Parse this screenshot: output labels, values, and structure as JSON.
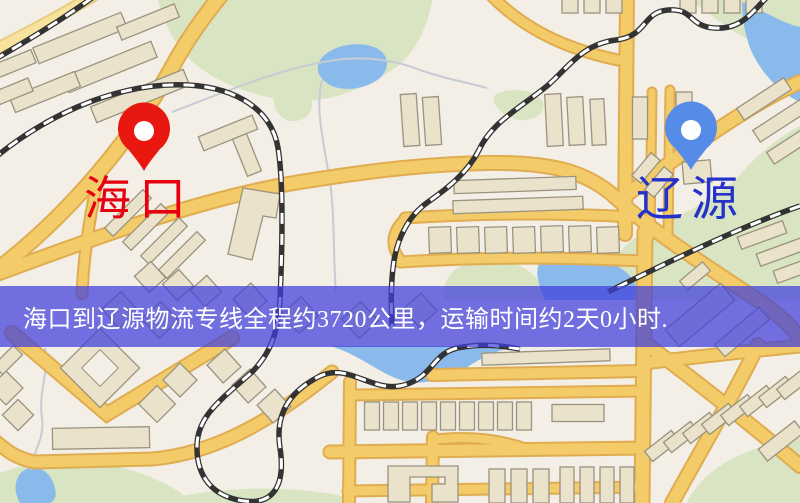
{
  "map": {
    "origin": {
      "label": "海口"
    },
    "destination": {
      "label": "辽源"
    },
    "banner": {
      "text": "海口到辽源物流专线全程约3720公里，运输时间约2天0小时."
    },
    "colors": {
      "origin_marker": "#e8170f",
      "origin_label": "#e60010",
      "destination_marker": "#568be8",
      "destination_label": "#2531cb",
      "banner_bg": "rgba(62,62,220,0.72)",
      "banner_text": "#ffffff"
    }
  }
}
